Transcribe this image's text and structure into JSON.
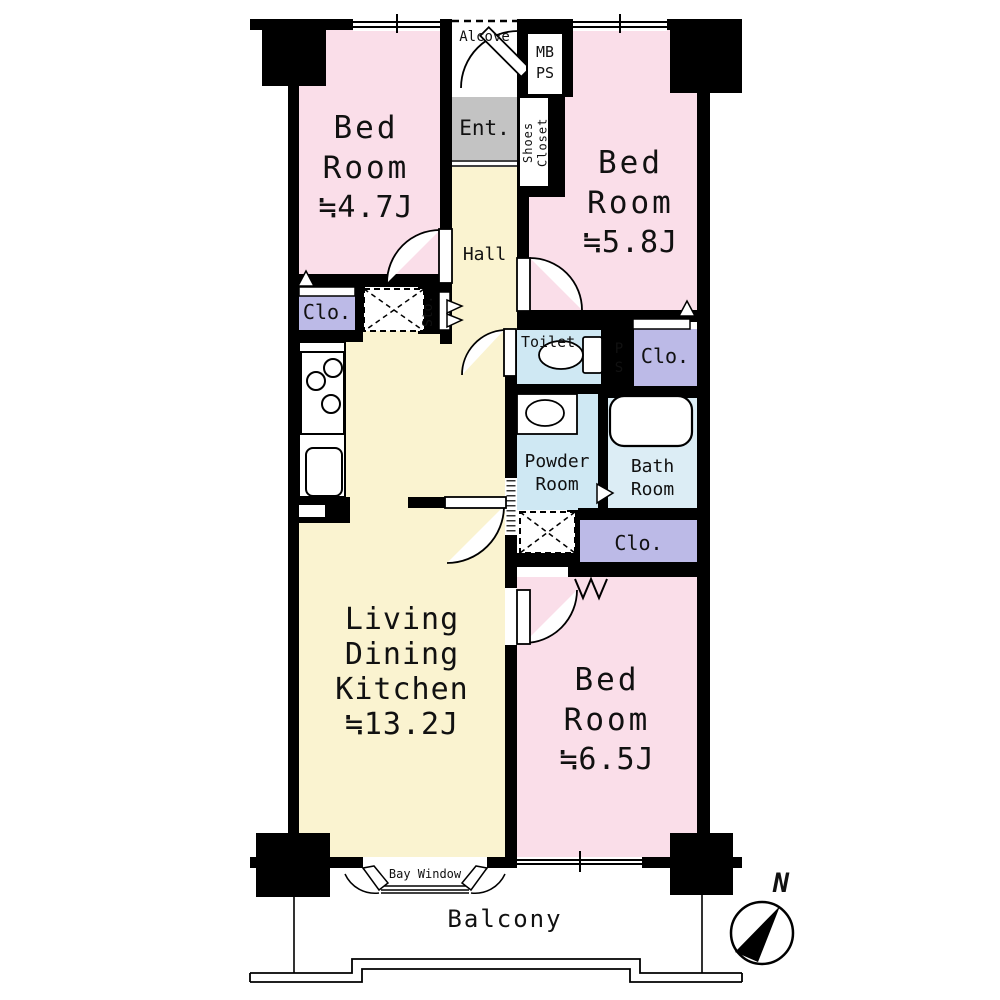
{
  "plan_title": "apartment-floor-plan",
  "rooms": {
    "bedroom_top_left": {
      "name_line1": "Bed",
      "name_line2": "Room",
      "size": "≒4.7J"
    },
    "bedroom_top_right": {
      "name_line1": "Bed",
      "name_line2": "Room",
      "size": "≒5.8J"
    },
    "bedroom_bottom": {
      "name_line1": "Bed",
      "name_line2": "Room",
      "size": "≒6.5J"
    },
    "ldk": {
      "name_line1": "Living",
      "name_line2": "Dining",
      "name_line3": "Kitchen",
      "size": "≒13.2J"
    },
    "hall": {
      "label": "Hall"
    },
    "alcove": {
      "label": "Alcove"
    },
    "entrance": {
      "label": "Ent."
    },
    "meter_box_pipe_space": {
      "label_line1": "MB",
      "label_line2": "PS"
    },
    "shoes_closet": {
      "label": "Shoes Closet"
    },
    "storage": {
      "label": "Sto."
    },
    "closet_upper_left": {
      "label": "Clo."
    },
    "closet_upper_right": {
      "label": "Clo."
    },
    "closet_lower": {
      "label": "Clo."
    },
    "pipe_space": {
      "label_line1": "P",
      "label_line2": "S"
    },
    "toilet": {
      "label": "Toilet"
    },
    "powder_room": {
      "label_line1": "Powder",
      "label_line2": "Room"
    },
    "bath_room": {
      "label_line1": "Bath",
      "label_line2": "Room"
    },
    "bay_window": {
      "label": "Bay Window"
    },
    "balcony": {
      "label": "Balcony"
    }
  },
  "compass": {
    "label": "N"
  },
  "colors": {
    "wall_black": "#000000",
    "room_pink": "#fadee9",
    "corridor_yellow": "#faf3d0",
    "closet_purple": "#bcbae7",
    "wet_area_blue": "#cfe8f3",
    "bath_blue": "#dcedf5",
    "entrance_gray": "#c3c3c3"
  }
}
